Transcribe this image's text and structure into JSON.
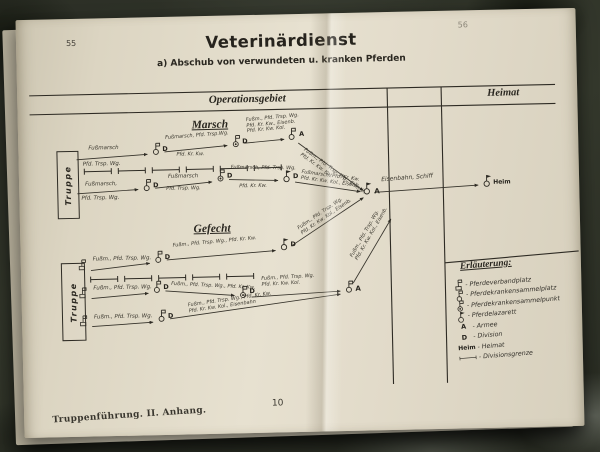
{
  "page": {
    "left_page_num": "55",
    "right_page_num": "56",
    "footer_imprint": "Truppenführung. II. Anhang.",
    "footer_page": "10"
  },
  "header": {
    "title": "Veterinärdienst",
    "subtitle": "a) Abschub von verwundeten u. kranken Pferden",
    "col_operations": "Operationsgebiet",
    "col_heimat": "Heimat"
  },
  "diagram": {
    "truppe": "Truppe",
    "d": "D",
    "a": "A",
    "heim": "Heim",
    "rail": "Eisenbahn, Schiff",
    "marsch": {
      "heading": "Marsch",
      "r1s1_top": "Fußmarsch",
      "r1s1_bot": "Pfd. Trsp. Wg.",
      "r1s2_top": "Fußmarsch, Pfd. Trsp.Wg.",
      "r1s2_bot": "Pfd. Kr. Kw.",
      "r1s3_1": "Fußm., Pfd. Trsp. Wg.",
      "r1s3_2": "Pfd. Kr. Kw., Eisenb.",
      "r1s3_3": "Pfd. Kr. Kw. Kol.",
      "r1d_1": "Fußm., Pfd. Trsp. Wg., Eisenb.",
      "r1d_2": "Pfd. Kr. Kw. Kol.",
      "r2s1_top": "Fußmarsch,",
      "r2s1_bot": "Pfd. Trsp. Wg.",
      "r2s2_top": "Fußmarsch",
      "r2s2_bot": "Pfd. Trsp. Wg.",
      "r2s3_top": "Fußmarsch, Pfd. Trsp. Wg.",
      "r2s3_bot": "Pfd. Kr. Kw.",
      "r2d_1": "Fußmarsch, Pfd. Kr. Kw.",
      "r2d_2": "Pfd. Kr. Kw. Kol., Eisenb."
    },
    "gefecht": {
      "heading": "Gefecht",
      "r1s1": "Fußm., Pfd. Trsp. Wg.",
      "r1s2": "Fußm., Pfd. Trsp. Wg., Pfd. Kr. Kw.",
      "r1d_1": "Fußm., Pfd. Trsp. Wg.",
      "r1d_2": "Pfd. Kr. Kw. Kol., Eisenb.",
      "r2s1": "Fußm., Pfd. Trsp. Wg.",
      "r2s2": "Fußm., Pfd. Trsp. Wg., Pfd. Kr. Kw.",
      "r2s3_1": "Fußm., Pfd. Trsp. Wg.",
      "r2s3_2": "Pfd. Kr. Kw. Kol.",
      "r3s1": "Fußm., Pfd. Trsp. Wg.",
      "r3m_1": "Fußm., Pfd. Trsp. Wg., Pfd. Kr. Kw.",
      "r3m_2": "Pfd. Kr. Kw. Kol., Eisenbahn",
      "ad_1": "Fußm., Pfd. Trsp. Wg.",
      "ad_2": "Pfd. Kr. Kw. Kol., Eisenb."
    }
  },
  "legend": {
    "title": "Erläuterung:",
    "sep": "-",
    "items": [
      {
        "icon": "verbandplatz-box-flag-icon",
        "label": "Pferdeverbandplatz"
      },
      {
        "icon": "sammelplatz-circle-flag-icon",
        "label": "Pferdekrankensammelplatz"
      },
      {
        "icon": "sammelpunkt-dot-circle-icon",
        "label": "Pferdekrankensammelpunkt"
      },
      {
        "icon": "lazarett-pennant-circle-icon",
        "label": "Pferdelazarett"
      },
      {
        "key": "A",
        "label": "Armee"
      },
      {
        "key": "D",
        "label": "Division"
      },
      {
        "key": "Heim",
        "label": "Heimat"
      },
      {
        "icon": "divisionsgrenze-tick-line-icon",
        "label": "Divisionsgrenze"
      }
    ]
  },
  "colors": {
    "ink": "#2e2b24",
    "paper": "#e4ddcb",
    "camo_dark": "#23261e",
    "camo_mid": "#32352b",
    "camo_light": "#585c52"
  }
}
